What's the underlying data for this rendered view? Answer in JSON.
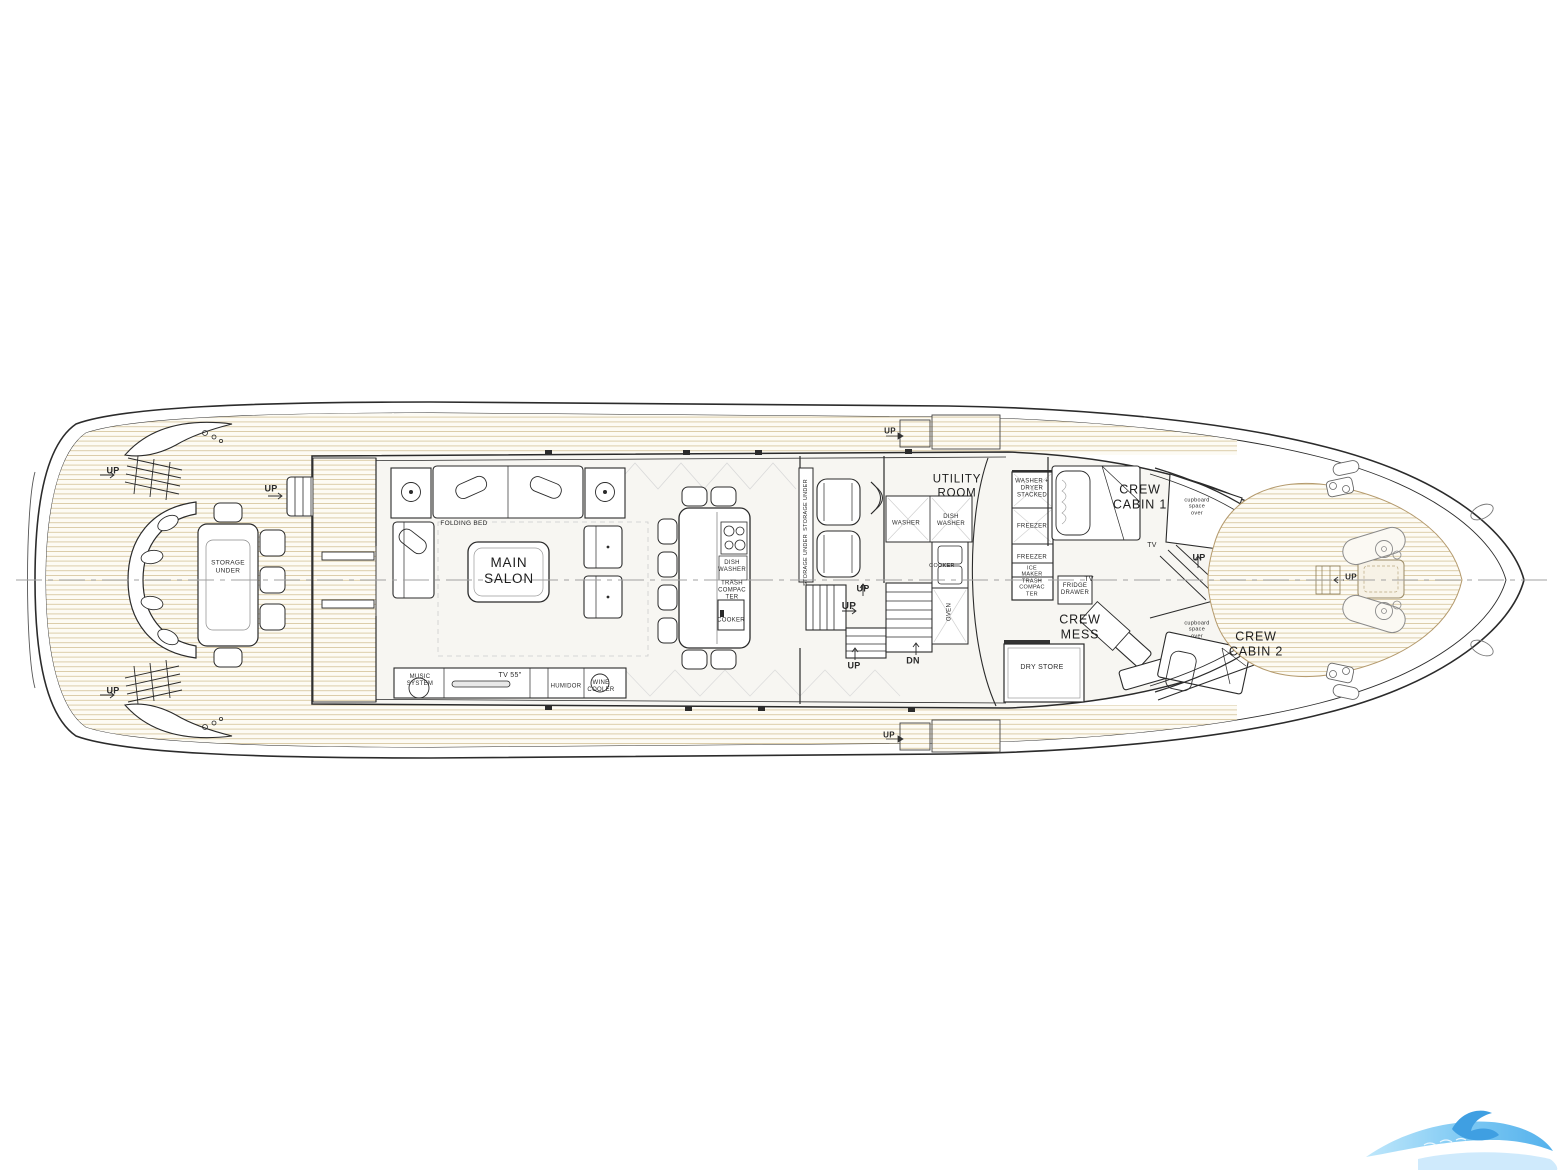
{
  "document": {
    "type": "yacht-main-deck-floor-plan",
    "background": "#ffffff"
  },
  "colors": {
    "line": "#2b2b2b",
    "wall": "#333333",
    "teak_line": "#d9c9a3",
    "teak_edge": "#b49a6d",
    "deck_fill": "#fdfbf4",
    "interior_fill": "#f7f6f2",
    "centerline": "#a0a0a0",
    "label_text": "#2a2a2a",
    "logo_blue_light": "#aadcf7",
    "logo_blue": "#54b1ec",
    "logo_blue_dark": "#3f9fe2"
  },
  "logo": {
    "name": "blue-wave-watermark"
  },
  "labels": [
    {
      "name": "up-aft-port",
      "text": "UP",
      "x": 113,
      "y": 471,
      "size": 9,
      "w": 600
    },
    {
      "name": "up-aft-stbd",
      "text": "UP",
      "x": 113,
      "y": 691,
      "size": 9,
      "w": 600
    },
    {
      "name": "up-aft-deck-stairs",
      "text": "UP",
      "x": 271,
      "y": 489,
      "size": 9,
      "w": 600
    },
    {
      "name": "up-sidedeck-top",
      "text": "UP",
      "x": 890,
      "y": 431,
      "size": 8,
      "w": 600
    },
    {
      "name": "up-sidedeck-bottom",
      "text": "UP",
      "x": 889,
      "y": 735,
      "size": 8,
      "w": 600
    },
    {
      "name": "up-helm-stairs-top",
      "text": "UP",
      "x": 863,
      "y": 589,
      "size": 9,
      "w": 600
    },
    {
      "name": "up-helm-stairs-mid",
      "text": "UP",
      "x": 849,
      "y": 607,
      "size": 10,
      "w": 600
    },
    {
      "name": "up-helm-stairs-low",
      "text": "UP",
      "x": 854,
      "y": 666,
      "size": 9,
      "w": 600
    },
    {
      "name": "dn-utility-stairs",
      "text": "DN",
      "x": 913,
      "y": 661,
      "size": 9,
      "w": 600
    },
    {
      "name": "up-crew-landing",
      "text": "UP",
      "x": 1199,
      "y": 558,
      "size": 9,
      "w": 600
    },
    {
      "name": "up-bow",
      "text": "UP",
      "x": 1351,
      "y": 577,
      "size": 8,
      "w": 600
    },
    {
      "name": "folding-bed",
      "text": "FOLDING BED",
      "x": 464,
      "y": 524,
      "size": 6.5
    },
    {
      "name": "main-salon",
      "text": "MAIN\nSALON",
      "x": 509,
      "y": 571,
      "size": 13.5,
      "room": true
    },
    {
      "name": "music-system",
      "text": "MUSIC\nSYSTEM",
      "x": 420,
      "y": 681,
      "size": 6
    },
    {
      "name": "tv-55",
      "text": "TV 55\"",
      "x": 510,
      "y": 676,
      "size": 7
    },
    {
      "name": "humidor",
      "text": "HUMIDOR",
      "x": 566,
      "y": 687,
      "size": 6
    },
    {
      "name": "wine-cooler",
      "text": "WINE\nCOOLER",
      "x": 601,
      "y": 687,
      "size": 6
    },
    {
      "name": "storage-under-aft-table",
      "text": "STORAGE\nUNDER",
      "x": 228,
      "y": 567,
      "size": 6.5
    },
    {
      "name": "island-dish-washer",
      "text": "DISH\nWASHER",
      "x": 732,
      "y": 567,
      "size": 6
    },
    {
      "name": "island-trash-compacter",
      "text": "TRASH\nCOMPAC\nTER",
      "x": 732,
      "y": 591,
      "size": 6
    },
    {
      "name": "island-cooker",
      "text": "COOKER",
      "x": 731,
      "y": 621,
      "size": 6
    },
    {
      "name": "helm-storage-under-1",
      "text": "STORAGE UNDER",
      "x": 806,
      "y": 505,
      "size": 5.5,
      "rot": -90
    },
    {
      "name": "helm-storage-under-2",
      "text": "STORAGE UNDER",
      "x": 806,
      "y": 560,
      "size": 5.5,
      "rot": -90
    },
    {
      "name": "utility-room",
      "text": "UTILITY\nROOM",
      "x": 957,
      "y": 487,
      "size": 11.5,
      "room": true
    },
    {
      "name": "utility-washer",
      "text": "WASHER",
      "x": 906,
      "y": 524,
      "size": 6
    },
    {
      "name": "utility-dish-washer",
      "text": "DISH\nWASHER",
      "x": 951,
      "y": 521,
      "size": 6
    },
    {
      "name": "utility-cooker",
      "text": "COOKER",
      "x": 942,
      "y": 566,
      "size": 5.5
    },
    {
      "name": "utility-oven",
      "text": "OVEN",
      "x": 950,
      "y": 612,
      "size": 6,
      "rot": -90
    },
    {
      "name": "washer-dryer-stacked",
      "text": "WASHER +\nDRYER\nSTACKED",
      "x": 1032,
      "y": 489,
      "size": 6
    },
    {
      "name": "freezer-upper",
      "text": "FREEZER",
      "x": 1032,
      "y": 527,
      "size": 6
    },
    {
      "name": "freezer-lower",
      "text": "FREEZER",
      "x": 1032,
      "y": 558,
      "size": 6
    },
    {
      "name": "ice-maker",
      "text": "ICE\nMAKER",
      "x": 1032,
      "y": 572,
      "size": 5.5
    },
    {
      "name": "utility-trash-compacter",
      "text": "TRASH\nCOMPAC\nTER",
      "x": 1032,
      "y": 588,
      "size": 5.5
    },
    {
      "name": "fridge-drawer",
      "text": "FRIDGE\nDRAWER",
      "x": 1075,
      "y": 590,
      "size": 6
    },
    {
      "name": "dry-store",
      "text": "DRY STORE",
      "x": 1042,
      "y": 668,
      "size": 7
    },
    {
      "name": "crew-mess",
      "text": "CREW\nMESS",
      "x": 1080,
      "y": 627,
      "size": 12.5,
      "room": true
    },
    {
      "name": "crew-cabin-1",
      "text": "CREW\nCABIN 1",
      "x": 1140,
      "y": 497,
      "size": 12.5,
      "room": true
    },
    {
      "name": "crew-cabin-2",
      "text": "CREW\nCABIN 2",
      "x": 1256,
      "y": 644,
      "size": 12.5,
      "room": true
    },
    {
      "name": "cupboard-space-over-1",
      "text": "cupboard\nspace\nover",
      "x": 1197,
      "y": 507,
      "size": 5.5
    },
    {
      "name": "cupboard-space-over-2",
      "text": "cupboard\nspace\nover",
      "x": 1197,
      "y": 630,
      "size": 5.5
    },
    {
      "name": "tv-crew-cabin-1",
      "text": "TV",
      "x": 1152,
      "y": 546,
      "size": 7
    },
    {
      "name": "tv-crew-mess",
      "text": "TV",
      "x": 1089,
      "y": 580,
      "size": 7
    }
  ]
}
